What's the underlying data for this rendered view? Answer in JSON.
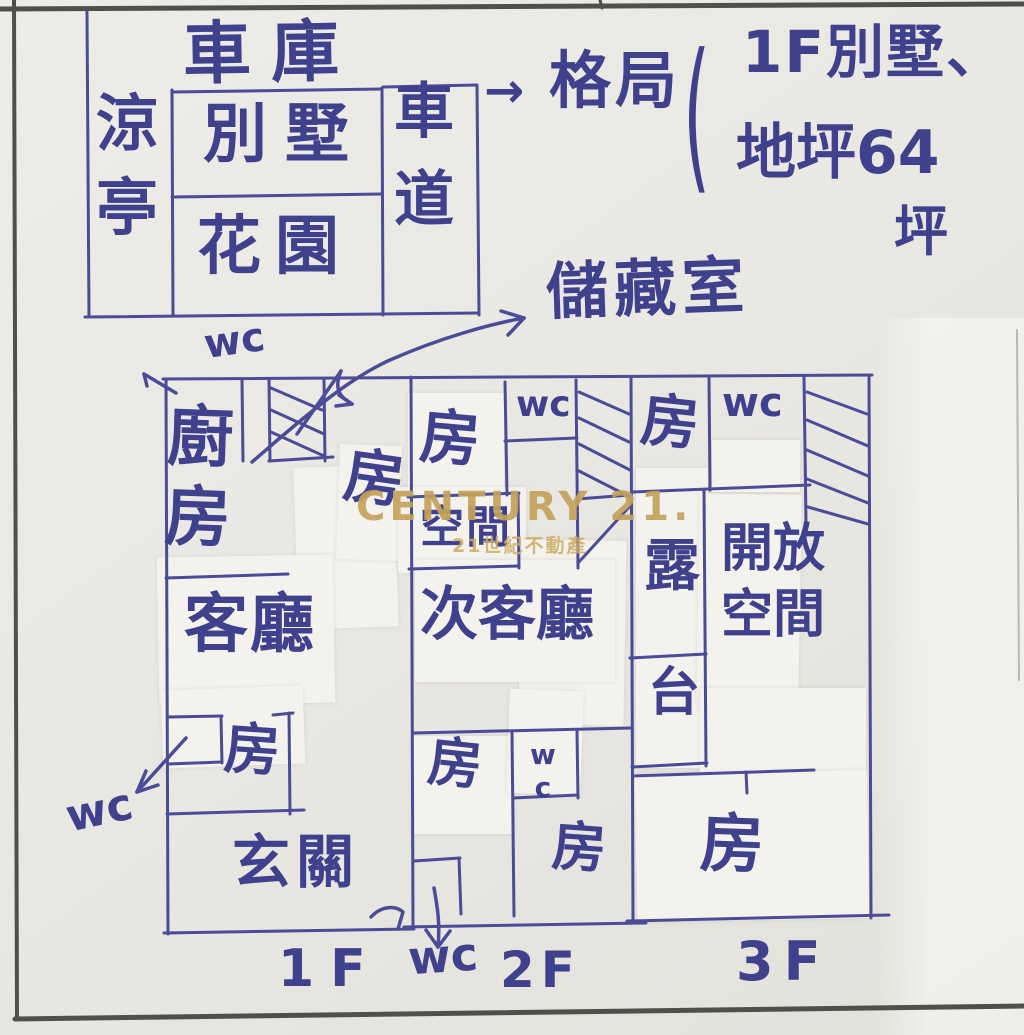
{
  "colors": {
    "ink": "#3f418c",
    "watermark_gold": "#c4a25c",
    "paper": "#e9e8e3"
  },
  "overview": {
    "garage": "車庫",
    "pavilion": "涼亭",
    "villa": "別墅",
    "garden": "花園",
    "driveway": "車道"
  },
  "annotation": {
    "arrow": "→",
    "title": "格局",
    "paren": "(",
    "line1": "1F別墅、",
    "line2": "地坪64",
    "line3": "坪",
    "storage": "儲藏室"
  },
  "plan": {
    "wc_above": "wc",
    "f1": {
      "kitchen": "廚房",
      "room_mid": "房",
      "living": "客廳",
      "room_bottom": "房",
      "wc_outside": "wc",
      "entry": "玄關"
    },
    "f2": {
      "room_top": "房",
      "wc_top": "wc",
      "space": "空間",
      "living2": "次客廳",
      "room_bottom_left": "房",
      "wc_bottom": "wc",
      "room_bottom_right": "房"
    },
    "f3": {
      "room_top": "房",
      "wc_top": "wc",
      "balcony_upper": "露",
      "balcony_lower": "台",
      "open_line1": "開放",
      "open_line2": "空間",
      "room_bottom": "房"
    },
    "floor_labels": {
      "f1": "1F",
      "wc": "wc",
      "f2": "2F",
      "f3": "3F"
    }
  },
  "watermark": {
    "brand": "CENTURY 21.",
    "sub": "21世紀不動產"
  }
}
